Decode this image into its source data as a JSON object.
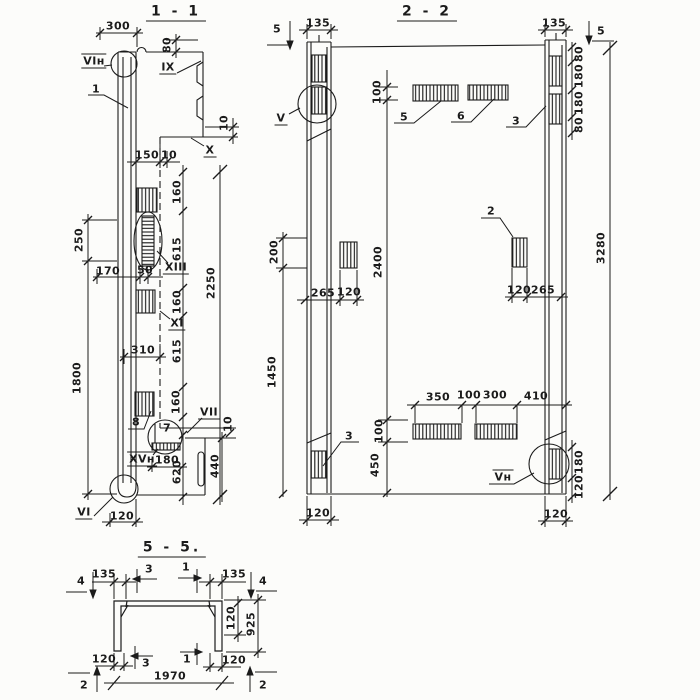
{
  "page": {
    "background": "#fcfcfa",
    "ink": "#1b1b1b"
  },
  "sections": {
    "s11": {
      "title": "1 - 1",
      "labels": [
        "300",
        "80",
        "VIн",
        "1",
        "IX",
        "10",
        "X",
        "150",
        "10",
        "160",
        "615",
        "2250",
        "250",
        "170",
        "50",
        "XIII",
        "160",
        "XI",
        "1800",
        "310",
        "615",
        "160",
        "8",
        "7",
        "VII",
        "10",
        "XVн",
        "180",
        "620",
        "440",
        "VI",
        "120"
      ]
    },
    "s22": {
      "title": "2 - 2",
      "labels": [
        "5",
        "135",
        "V",
        "100",
        "5",
        "6",
        "135",
        "5",
        "80",
        "180",
        "180",
        "80",
        "3",
        "200",
        "2400",
        "2",
        "3280",
        "265",
        "120",
        "120",
        "265",
        "1450",
        "3",
        "350",
        "100",
        "300",
        "410",
        "100",
        "450",
        "Vн",
        "180",
        "120",
        "120",
        "120"
      ]
    },
    "s55": {
      "title": "5 - 5.",
      "labels": [
        "4",
        "135",
        "3",
        "1",
        "135",
        "4",
        "120",
        "925",
        "120",
        "3",
        "1",
        "120",
        "1970",
        "2",
        "2"
      ]
    }
  }
}
